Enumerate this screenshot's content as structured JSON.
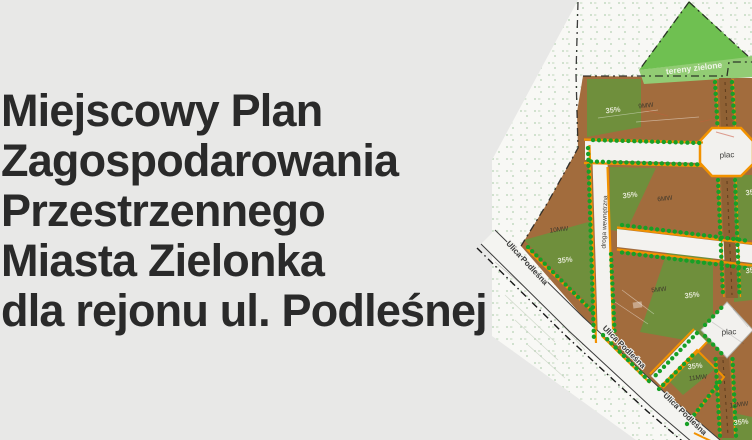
{
  "title": {
    "lines": [
      "Miejscowy Plan",
      "Zagospodarowania",
      "Przestrzennego",
      "Miasta Zielonka",
      "dla rejonu ul. Podleśnej"
    ]
  },
  "map": {
    "labels": [
      {
        "text": "tereny zielone"
      },
      {
        "text": "35%"
      },
      {
        "text": "9MW"
      },
      {
        "text": "plac"
      },
      {
        "text": "35%"
      },
      {
        "text": "35%"
      },
      {
        "text": "6MW"
      },
      {
        "text": "droga wewnętrzna"
      },
      {
        "text": "10MW"
      },
      {
        "text": "35%"
      },
      {
        "text": "35%"
      },
      {
        "text": "5MW"
      },
      {
        "text": "35%"
      },
      {
        "text": "plac"
      },
      {
        "text": "35%"
      },
      {
        "text": "11MW"
      },
      {
        "text": "12MW"
      },
      {
        "text": "35%"
      },
      {
        "text": "Ulica Podleśna"
      },
      {
        "text": "Ulica Podleśna"
      },
      {
        "text": "Ulica Podleśna"
      }
    ]
  },
  "palette": {
    "background": "#e8e8e7",
    "title_text": "#2a2a2a",
    "sheet_white": "#f8f8f5",
    "zone_brown": "#a26c3d",
    "coverage_green": "#6f8f3c",
    "park_green": "#6fc051",
    "park_light_green": "#92cc74",
    "tree_green": "#17a026",
    "road_orange": "#f29200",
    "road_white": "#f3f2ef"
  }
}
